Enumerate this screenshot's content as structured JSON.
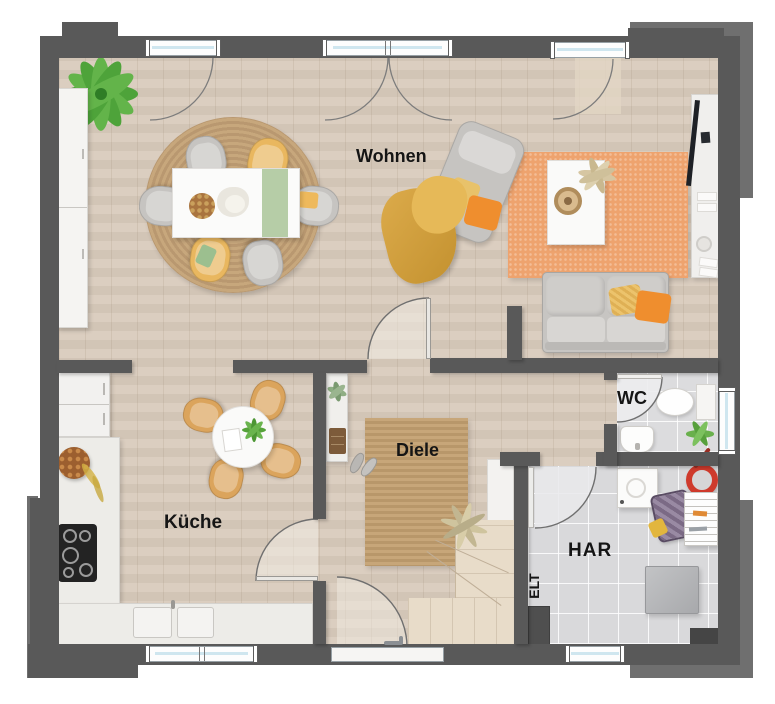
{
  "labels": {
    "wohnen": "Wohnen",
    "kueche": "Küche",
    "diele": "Diele",
    "wc": "WC",
    "har": "HAR",
    "elt": "ELT"
  },
  "colors": {
    "wall": "#595959",
    "wallLight": "#6f6f6f",
    "wood": "#d9cbbc",
    "tile": "#d9d9db",
    "jute": "#c2a176",
    "rugOrange": "#eea36e",
    "counter": "#edece8",
    "sofa": "#c7c5c2",
    "yellow": "#e9b75f",
    "orange": "#ef8e2e",
    "green": "#55a23a",
    "woodChair": "#dba45c",
    "red": "#cf3a2c",
    "stair": "#e8dcc9"
  }
}
